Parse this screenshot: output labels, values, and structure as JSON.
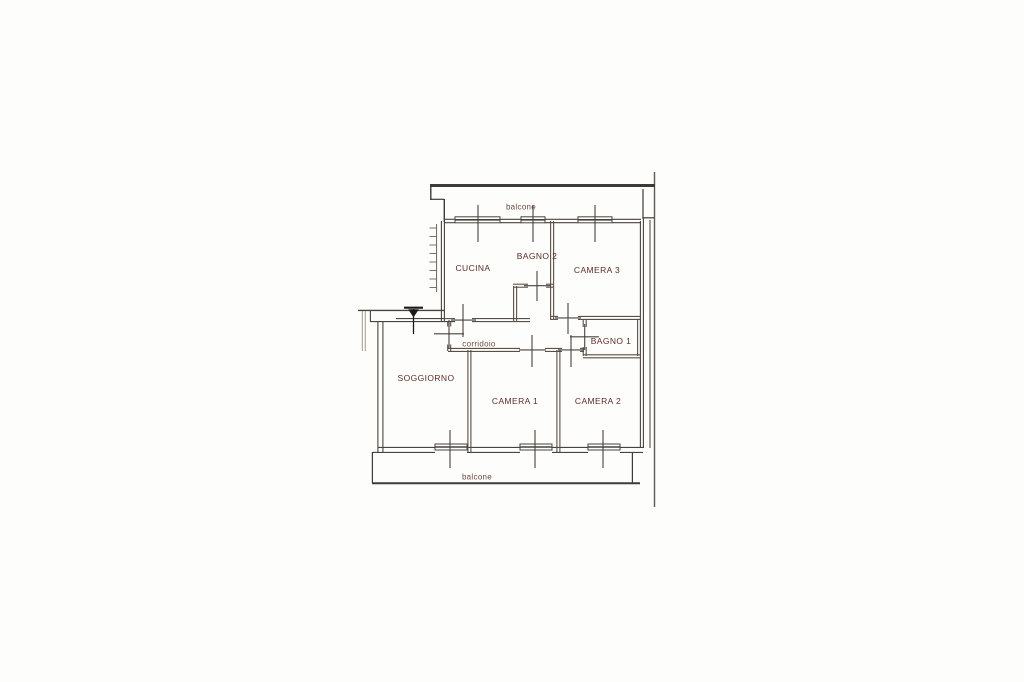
{
  "canvas": {
    "width": 1024,
    "height": 682,
    "background": "#fdfdfc"
  },
  "floor_plan": {
    "kind": "apartment floor plan drawing",
    "language": "Italian",
    "colors": {
      "wall_line": "#49433d",
      "faded_line": "#a29a8e",
      "room_label": "#5c2d26",
      "annotation_label": "#6b4a40",
      "entrance_arrow": "#1d1a17"
    },
    "rooms": [
      {
        "id": "balcone-top",
        "label": "balcone"
      },
      {
        "id": "cucina",
        "label": "CUCINA"
      },
      {
        "id": "bagno-2",
        "label": "BAGNO 2"
      },
      {
        "id": "camera-3",
        "label": "CAMERA 3"
      },
      {
        "id": "corridoio",
        "label": "corridoio"
      },
      {
        "id": "bagno-1",
        "label": "BAGNO 1"
      },
      {
        "id": "soggiorno",
        "label": "SOGGIORNO"
      },
      {
        "id": "camera-1",
        "label": "CAMERA 1"
      },
      {
        "id": "camera-2",
        "label": "CAMERA 2"
      },
      {
        "id": "balcone-bottom",
        "label": "balcone"
      }
    ]
  }
}
